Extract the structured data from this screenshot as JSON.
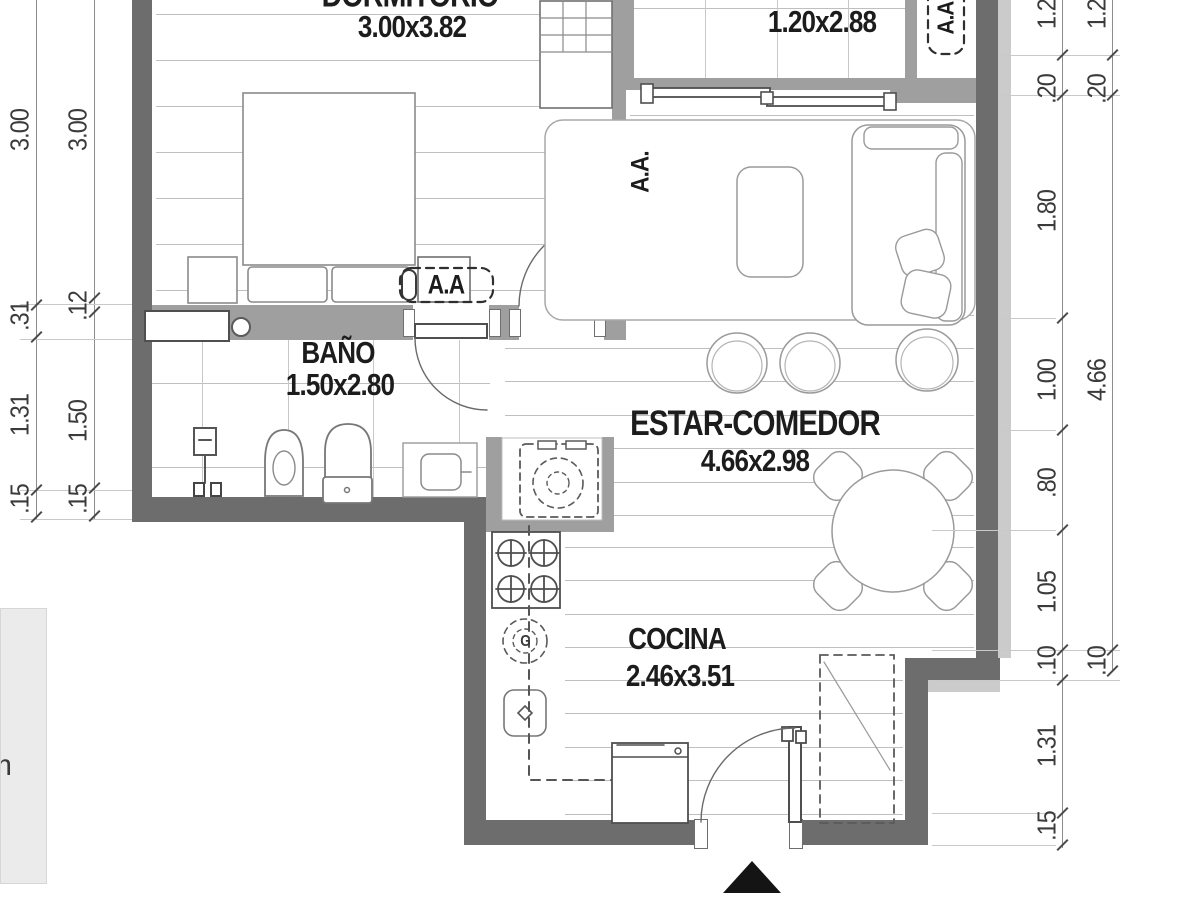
{
  "plan": {
    "rooms": [
      {
        "id": "dormitorio",
        "name": "DORMITORIO",
        "size": "3.00x3.82"
      },
      {
        "id": "balcon",
        "name": "",
        "size": "1.20x2.88"
      },
      {
        "id": "bano",
        "name": "BAÑO",
        "size": "1.50x2.80"
      },
      {
        "id": "estar_comedor",
        "name": "ESTAR-COMEDOR",
        "size": "4.66x2.98"
      },
      {
        "id": "cocina",
        "name": "COCINA",
        "size": "2.46x3.51"
      }
    ],
    "ac_labels": {
      "dormitorio": "A.A",
      "estar": "A.A.",
      "balcon": "A.A"
    },
    "gas_meter_label": "G",
    "partial_text": "m"
  },
  "dimensions": {
    "left_outer": [
      "3.00",
      ".31",
      "1.31",
      ".15"
    ],
    "left_inner": [
      "3.00",
      ".12",
      "1.50",
      ".15"
    ],
    "right_inner": [
      "1.20",
      ".20",
      "1.80",
      "1.00",
      ".80",
      "1.05",
      ".10",
      "1.31",
      ".15"
    ],
    "right_outer": [
      "1.20",
      ".20",
      "4.66",
      ".10"
    ]
  }
}
